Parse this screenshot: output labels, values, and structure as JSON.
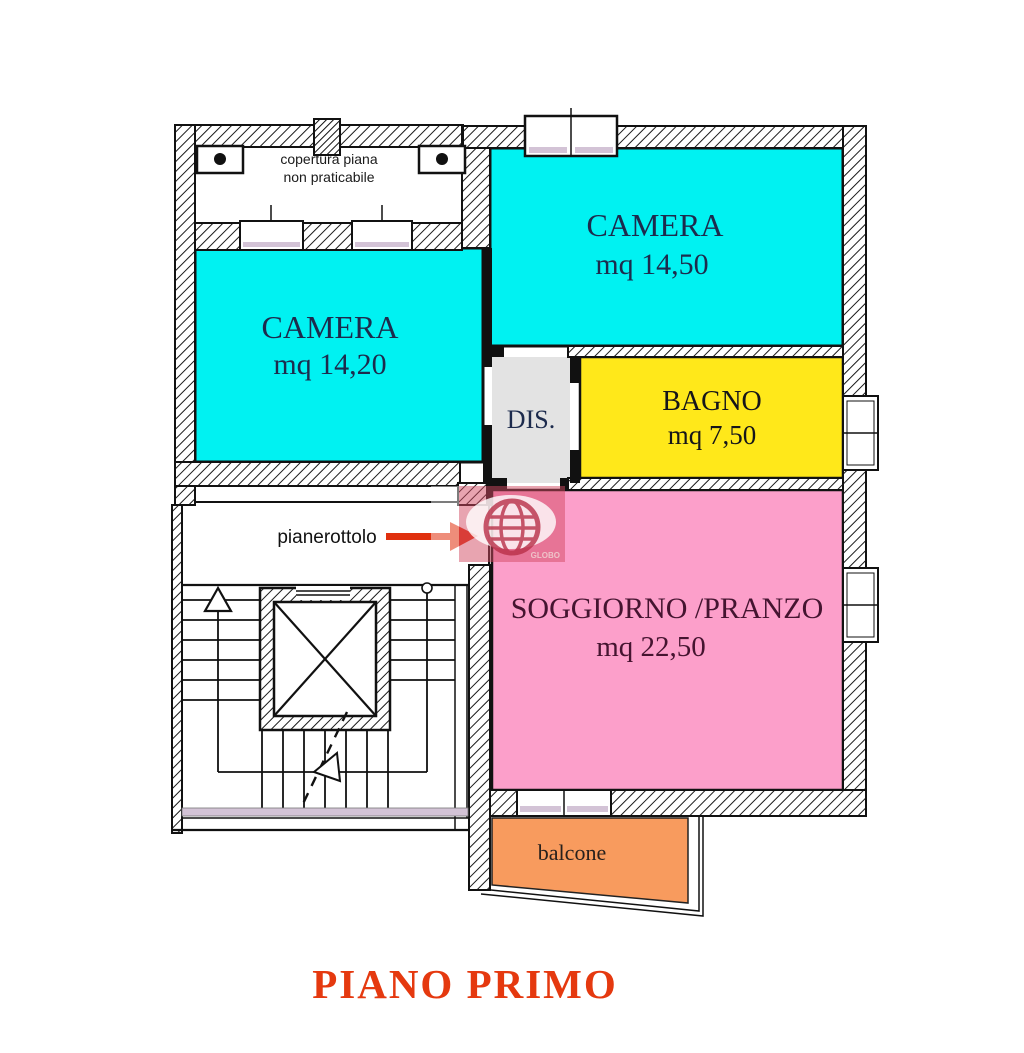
{
  "title": {
    "text": "PIANO PRIMO",
    "color": "#e5390f"
  },
  "labels": {
    "roof_line1": "copertura piana",
    "roof_line2": "non praticabile",
    "landing": "pianerottolo",
    "watermark": "GLOBO"
  },
  "rooms": {
    "camera_left": {
      "name": "CAMERA",
      "area": "mq 14,20",
      "color": "#00f2f2"
    },
    "camera_right": {
      "name": "CAMERA",
      "area": "mq 14,50",
      "color": "#00f2f2"
    },
    "bagno": {
      "name": "BAGNO",
      "area": "mq 7,50",
      "color": "#ffe81a"
    },
    "dis": {
      "name": "DIS.",
      "color": "#e3e3e3"
    },
    "soggiorno": {
      "name": "SOGGIORNO /PRANZO",
      "area": "mq 22,50",
      "color": "#fc9fca"
    },
    "balcone": {
      "name": "balcone",
      "color": "#f89b5e"
    }
  },
  "colors": {
    "entrance_arrow": "#e0300e",
    "watermark_red": "#d24a62",
    "window_sill": "#d3c3d6"
  }
}
